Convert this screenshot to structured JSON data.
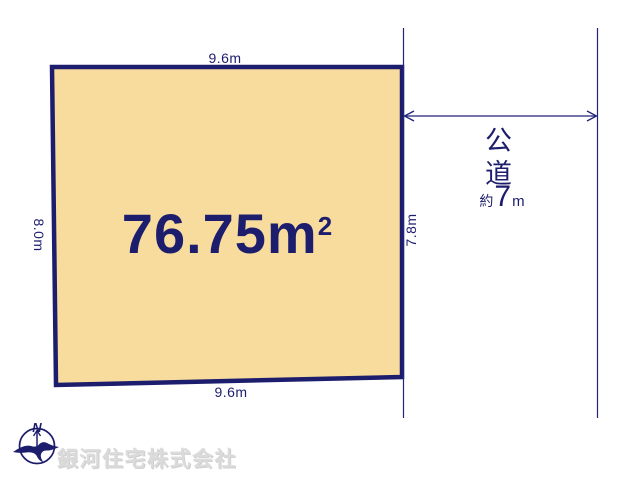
{
  "plot": {
    "area": "76.75m",
    "area_sup": "2",
    "dim_top": "9.6m",
    "dim_bottom": "9.6m",
    "dim_left": "8.0m",
    "dim_right": "7.8m"
  },
  "road": {
    "name": "公道",
    "width_prefix": "約",
    "width_value": "7",
    "width_unit": "m"
  },
  "compass": {
    "north": "N"
  },
  "watermark": {
    "company": "銀河住宅株式会社"
  },
  "colors": {
    "navy": "#1d1d6e",
    "plot_fill": "#f8dc9d",
    "thin_line": "#23237a",
    "watermark_gray": "#dbdbdb"
  }
}
